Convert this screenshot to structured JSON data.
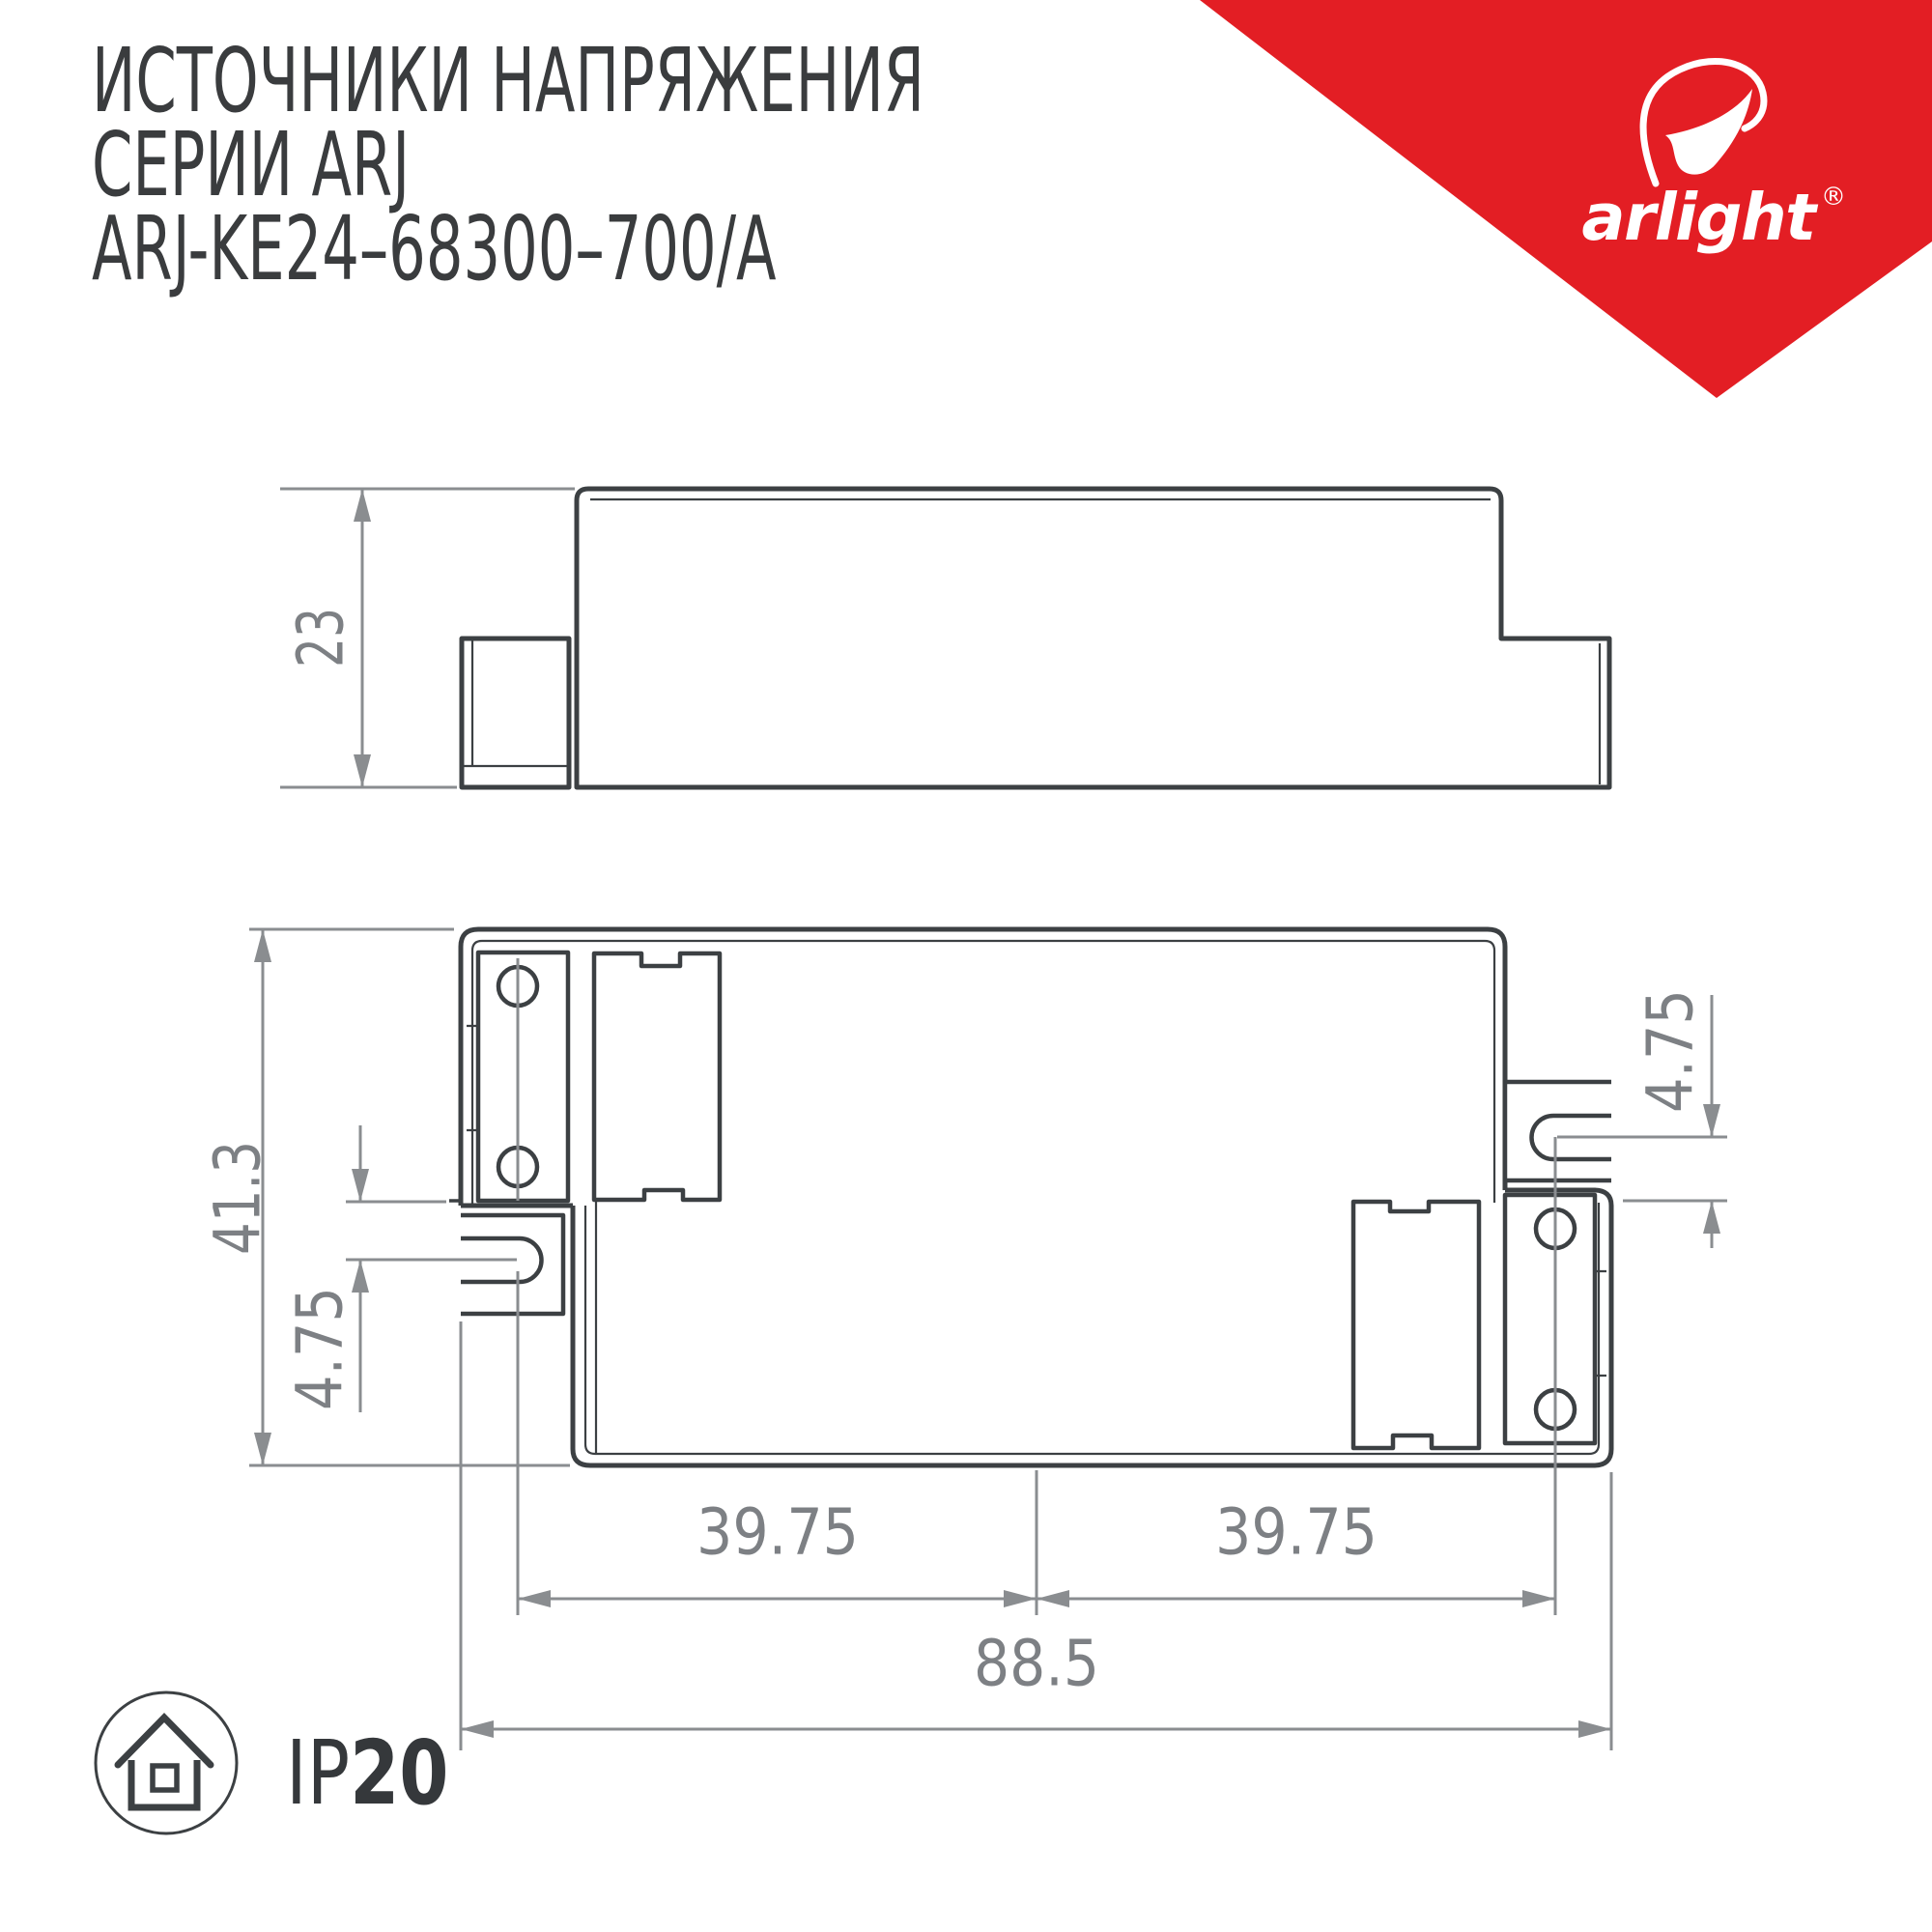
{
  "title": {
    "line1": "ИСТОЧНИКИ НАПРЯЖЕНИЯ",
    "line2": "СЕРИИ ARJ",
    "line3": "ARJ-KE24–68300–700/A"
  },
  "logo": {
    "brand": "arlight",
    "registered": "®",
    "triangle_color": "#e31e24",
    "mark_color": "#ffffff"
  },
  "drawing": {
    "outline_color": "#3c4043",
    "dim_line_color": "#8a8d90",
    "dim_text_color": "#7d8084",
    "side_view": {
      "height": "23"
    },
    "top_view": {
      "overall_height": "41.3",
      "slot_offset_left": "4.75",
      "slot_offset_right": "4.75",
      "hole_span_left": "39.75",
      "hole_span_right": "39.75",
      "overall_width": "88.5"
    }
  },
  "footer": {
    "ip_prefix": "IP",
    "ip_value": "20"
  }
}
